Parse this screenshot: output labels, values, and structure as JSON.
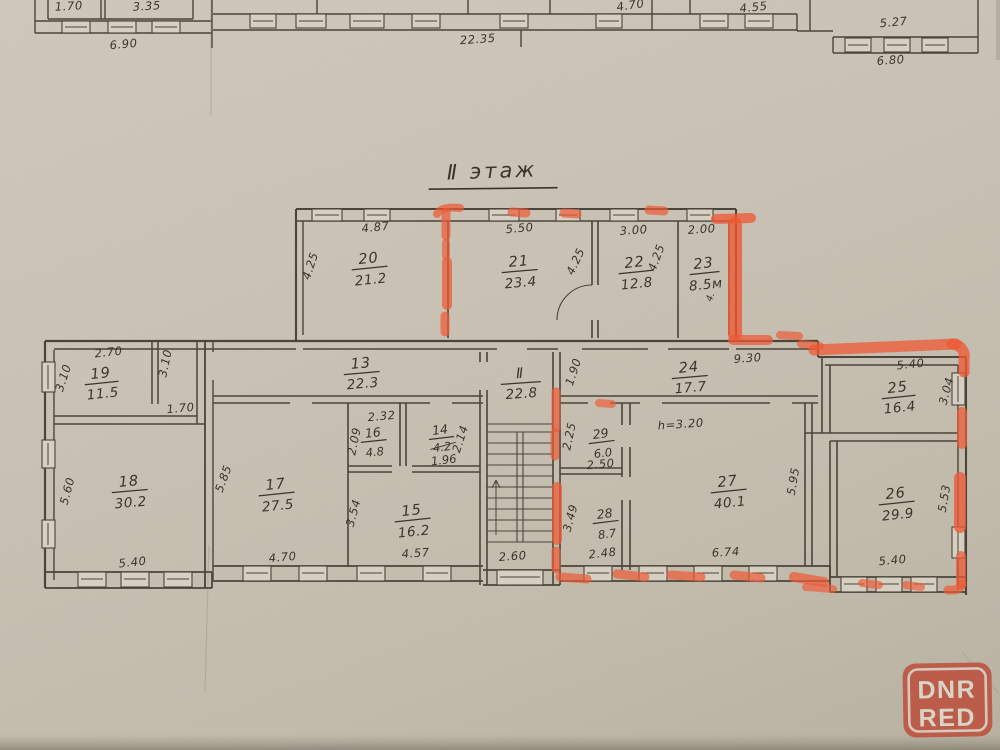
{
  "title": "Ⅱ этаж",
  "watermark": {
    "line1": "DNR",
    "line2": "RED"
  },
  "colors": {
    "paper": "#cbc4b6",
    "pencil": "#4b443a",
    "handwriting": "#3a342b",
    "marker": "#ee5a36",
    "logo_red": "#bb4d39"
  },
  "rooms": {
    "r20": {
      "number": "20",
      "area": "21.2"
    },
    "r21": {
      "number": "21",
      "area": "23.4"
    },
    "r22": {
      "number": "22",
      "area": "12.8"
    },
    "r23": {
      "number": "23",
      "area": "8.5м"
    },
    "r19": {
      "number": "19",
      "area": "11.5"
    },
    "r13": {
      "number": "13",
      "area": "22.3"
    },
    "r24": {
      "number": "24",
      "area": "17.7"
    },
    "r25": {
      "number": "25",
      "area": "16.4"
    },
    "r18": {
      "number": "18",
      "area": "30.2"
    },
    "r17": {
      "number": "17",
      "area": "27.5"
    },
    "r16": {
      "number": "16",
      "area": "4.8"
    },
    "r14": {
      "number": "14",
      "area_old": "4.2",
      "area": "1.96"
    },
    "r15": {
      "number": "15",
      "area": "16.2"
    },
    "r29": {
      "number": "29",
      "area": "6.0"
    },
    "r28": {
      "number": "28",
      "area": "8.7"
    },
    "r27": {
      "number": "27",
      "area": "40.1"
    },
    "r26": {
      "number": "26",
      "area": "29.9"
    },
    "stair": {
      "number": "Ⅱ",
      "area": "22.8"
    }
  },
  "dims": {
    "t170": "1.70",
    "t335": "3.35",
    "t690": "6.90",
    "t2235": "22.35",
    "t470": "4.70",
    "t455": "4.55",
    "t527": "5.27",
    "t680": "6.80",
    "w20": "4.87",
    "h20": "4.25",
    "w21": "5.50",
    "h21": "4.25",
    "w22": "3.00",
    "h22": "4.25",
    "w23": "2.00",
    "h23": "4.",
    "w19": "2.70",
    "hl19": "3.10",
    "hr19": "3.10",
    "b19": "1.70",
    "h18": "5.60",
    "b18": "5.40",
    "h17": "5.85",
    "b17": "4.70",
    "w16": "2.32",
    "h16": "2.09",
    "h14": "2.14",
    "h15": "3.54",
    "b15": "4.57",
    "bst": "2.60",
    "h24": "1.90",
    "w24": "9.30",
    "w25": "5.40",
    "h25": "3.04",
    "note27": "h=3.20",
    "h29": "2.25",
    "b29": "2.50",
    "h28": "3.49",
    "b28": "2.48",
    "b27": "6.74",
    "h27": "5.95",
    "h26": "5.53",
    "b26": "5.40"
  }
}
